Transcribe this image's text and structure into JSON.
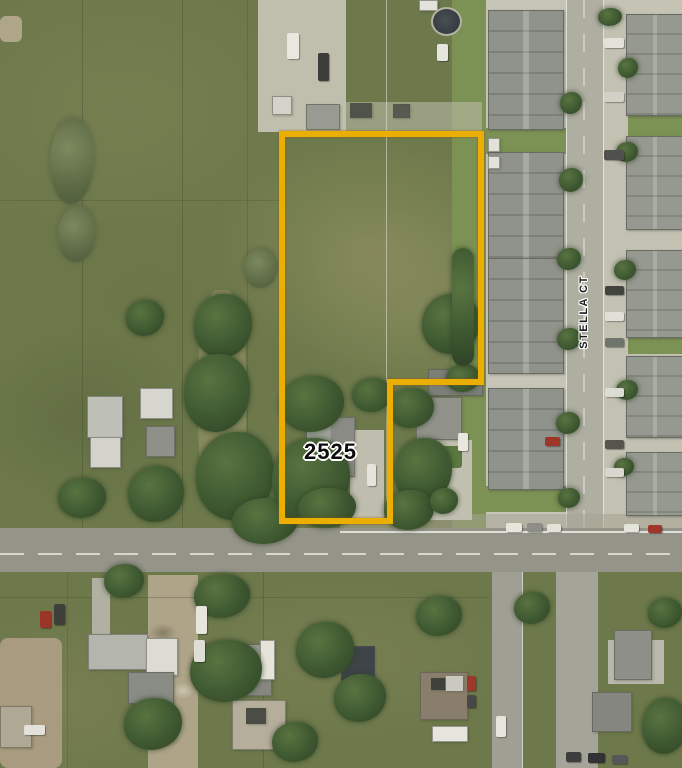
{
  "map": {
    "description": "Aerial parcel map with highlighted property boundary",
    "parcel": {
      "label": "2525",
      "boundary_color": "#F2B300"
    },
    "streets": [
      {
        "label": "STELLA CT",
        "orientation": "vertical"
      }
    ]
  }
}
